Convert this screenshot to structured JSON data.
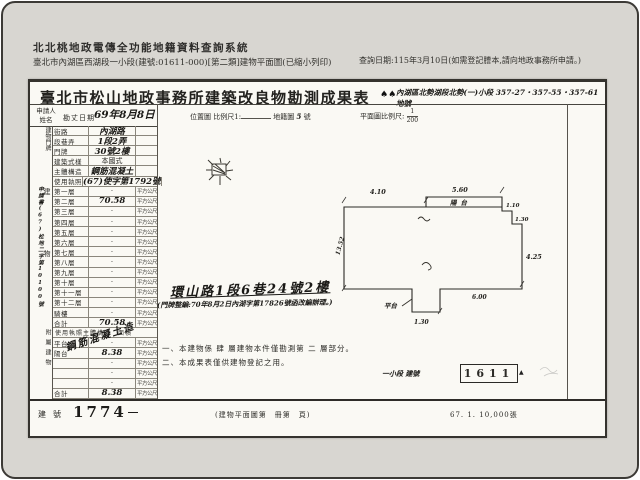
{
  "header": {
    "system_title": "北北桃地政電傳全功能地籍資料查詢系統",
    "document_line": "臺北市內湖區西湖段一小段(建號:01611-000)[第二類]建物平面圖(已縮小列印)",
    "query_date": "查詢日期:115年3月10日(如需登記謄本,請向地政事務所申請。)"
  },
  "form": {
    "title": "臺北市松山地政事務所建築改良物勘測成果表",
    "ink_marks": "♠♠",
    "land_number_line": "內湖區北勢湖段北勢(一)小段 357-27・357-55・357-61 地號",
    "header_row": {
      "applicant_label": "申請人 姓名",
      "survey_date_label": "勘丈日期",
      "survey_date_value": "69年8月8日",
      "location_map_label": "位置圖",
      "location_scale_label": "比例尺1:",
      "cadastral_map_label": "地籍圖",
      "cadastral_map_no": "5",
      "cadastral_map_unit": "號",
      "plan_scale_label": "平面圖比例尺:",
      "plan_scale_num": "1",
      "plan_scale_den": "200"
    },
    "application_no": "申請書(67)松地二字第10100號",
    "group_labels": {
      "address": "建物門牌",
      "building": "建物",
      "annex": "附屬建物"
    },
    "table_rows": [
      {
        "label": "街路",
        "value": "內湖路",
        "hw": true
      },
      {
        "label": "段巷弄",
        "value": "1段2弄",
        "hw": true
      },
      {
        "label": "門牌",
        "value": "30號2樓",
        "hw": true
      },
      {
        "label": "建築式樣",
        "value": "本國式"
      },
      {
        "label": "主體構造",
        "value": "鋼筋混凝土",
        "hw": true
      },
      {
        "label": "使用執照",
        "value": "(67)使字第1792號",
        "hw": true
      },
      {
        "label": "第一層",
        "unit": "平方公尺"
      },
      {
        "label": "第二層",
        "value": "70.58",
        "unit": "平方公尺",
        "hw": true
      },
      {
        "label": "第三層",
        "unit": "平方公尺"
      },
      {
        "label": "第四層",
        "unit": "平方公尺"
      },
      {
        "label": "第五層",
        "unit": "平方公尺"
      },
      {
        "label": "第六層",
        "unit": "平方公尺"
      },
      {
        "label": "第七層",
        "unit": "平方公尺"
      },
      {
        "label": "第八層",
        "unit": "平方公尺"
      },
      {
        "label": "第九層",
        "unit": "平方公尺"
      },
      {
        "label": "第十層",
        "unit": "平方公尺"
      },
      {
        "label": "第十一層",
        "unit": "平方公尺"
      },
      {
        "label": "第十二層",
        "unit": "平方公尺"
      },
      {
        "label": "騎樓",
        "unit": "平方公尺"
      },
      {
        "label": "合計",
        "value": "70.58",
        "unit": "平方公尺",
        "hw": true
      },
      {
        "header": "使用執照主體構造　面積"
      },
      {
        "label": "平台",
        "unit": "平方公尺"
      },
      {
        "label": "陽台",
        "value": "8.38",
        "unit": "平方公尺",
        "hw": true
      },
      {
        "label": "",
        "unit": "平方公尺"
      },
      {
        "label": "",
        "unit": "平方公尺"
      },
      {
        "label": "",
        "unit": "平方公尺"
      },
      {
        "label": "合計",
        "value": "8.38",
        "unit": "平方公尺",
        "hw": true
      }
    ],
    "diagonal_note": "鋼筋混凝土造",
    "handwritten_address": "環山路1段6巷24號2樓",
    "renumber_note": "(門牌整編:70年8月2日內湖字第17826號函改編辦理。)",
    "notes": [
      "一、本建物係 肆 層建物本件僅勘測第 二 層部分。",
      "二、本成果表僅供建物登記之用。"
    ],
    "plan": {
      "dims": {
        "top_left": "4.10",
        "top_right": "5.60",
        "step1": "1.10",
        "step2": "1.30",
        "right": "4.25",
        "bottom_left": "1.30",
        "bottom": "6.00",
        "left": "13.52"
      },
      "labels": {
        "balcony": "陽台",
        "platform": "平台"
      }
    },
    "section_no_prefix": "一小段 建號",
    "section_no_value": "1611",
    "building_no_label": "建號",
    "building_no_value": "1774",
    "book_page_note": "(建物平面圖第　冊第　頁)",
    "print_code": "67. 1. 10,000張"
  }
}
